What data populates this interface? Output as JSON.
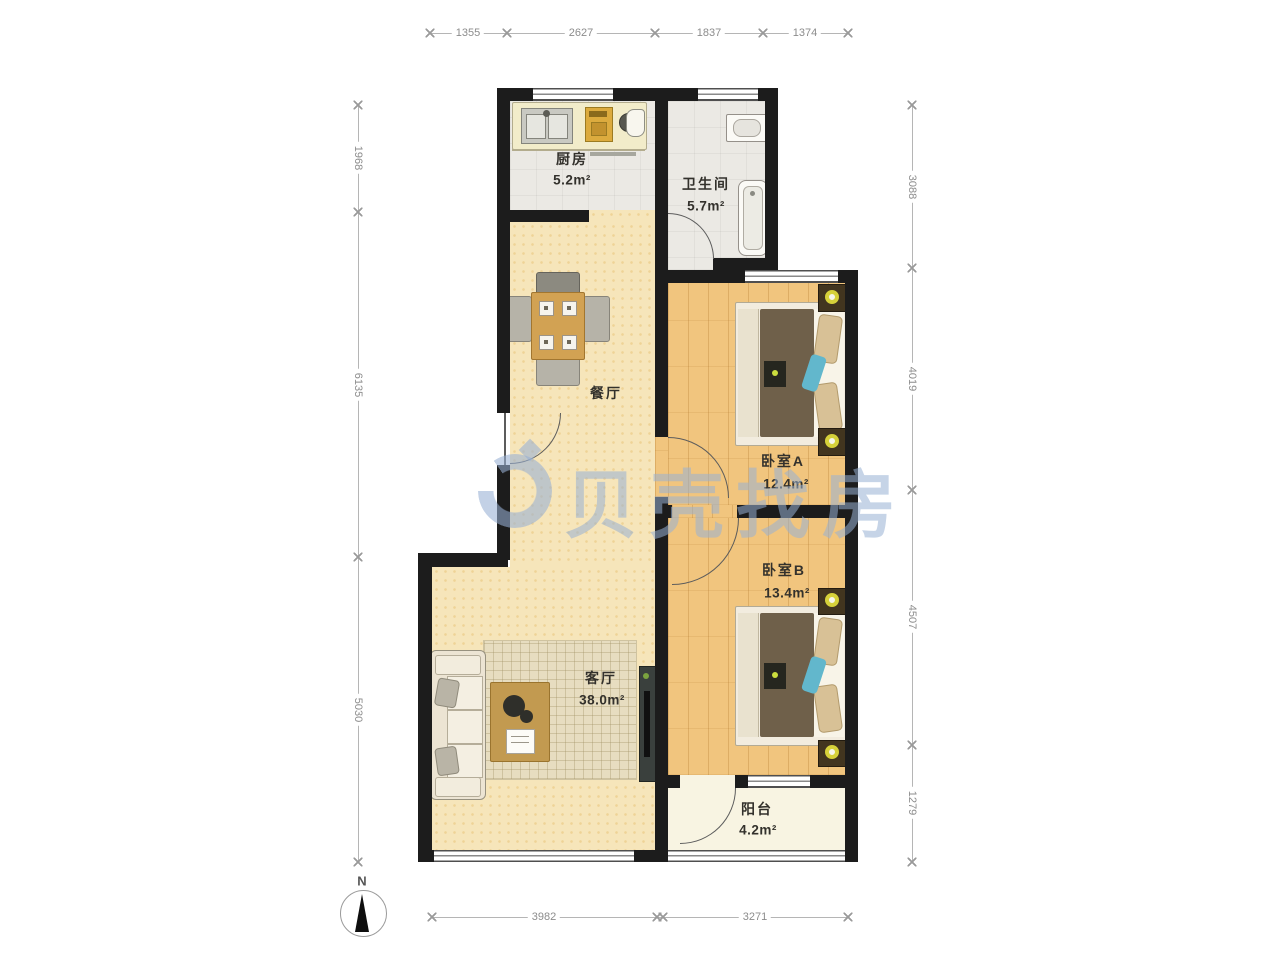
{
  "watermark": {
    "text": "贝壳找房"
  },
  "compass": {
    "north_label": "N"
  },
  "rooms": {
    "kitchen": {
      "name": "厨房",
      "area": "5.2m²"
    },
    "bathroom": {
      "name": "卫生间",
      "area": "5.7m²"
    },
    "dining": {
      "name": "餐厅"
    },
    "bedroomA": {
      "name": "卧室A",
      "area": "12.4m²"
    },
    "bedroomB": {
      "name": "卧室B",
      "area": "13.4m²"
    },
    "living": {
      "name": "客厅",
      "area": "38.0m²"
    },
    "balcony": {
      "name": "阳台",
      "area": "4.2m²"
    }
  },
  "dimensions": {
    "top": [
      "1355",
      "2627",
      "1837",
      "1374"
    ],
    "bottom": [
      "3982",
      "3271"
    ],
    "left": [
      "1968",
      "6135",
      "5030"
    ],
    "right": [
      "3088",
      "4019",
      "4507",
      "1279"
    ]
  },
  "colors": {
    "wall": "#1c1c1c",
    "hall_floor": "#f6e5ba",
    "bedroom_floor": "#f1c57e",
    "tile_floor": "#ebe9e4",
    "balcony_floor": "#f8f4e2",
    "watermark_blue": "#98b0d4",
    "dimension_gray": "#8c8c8c"
  }
}
